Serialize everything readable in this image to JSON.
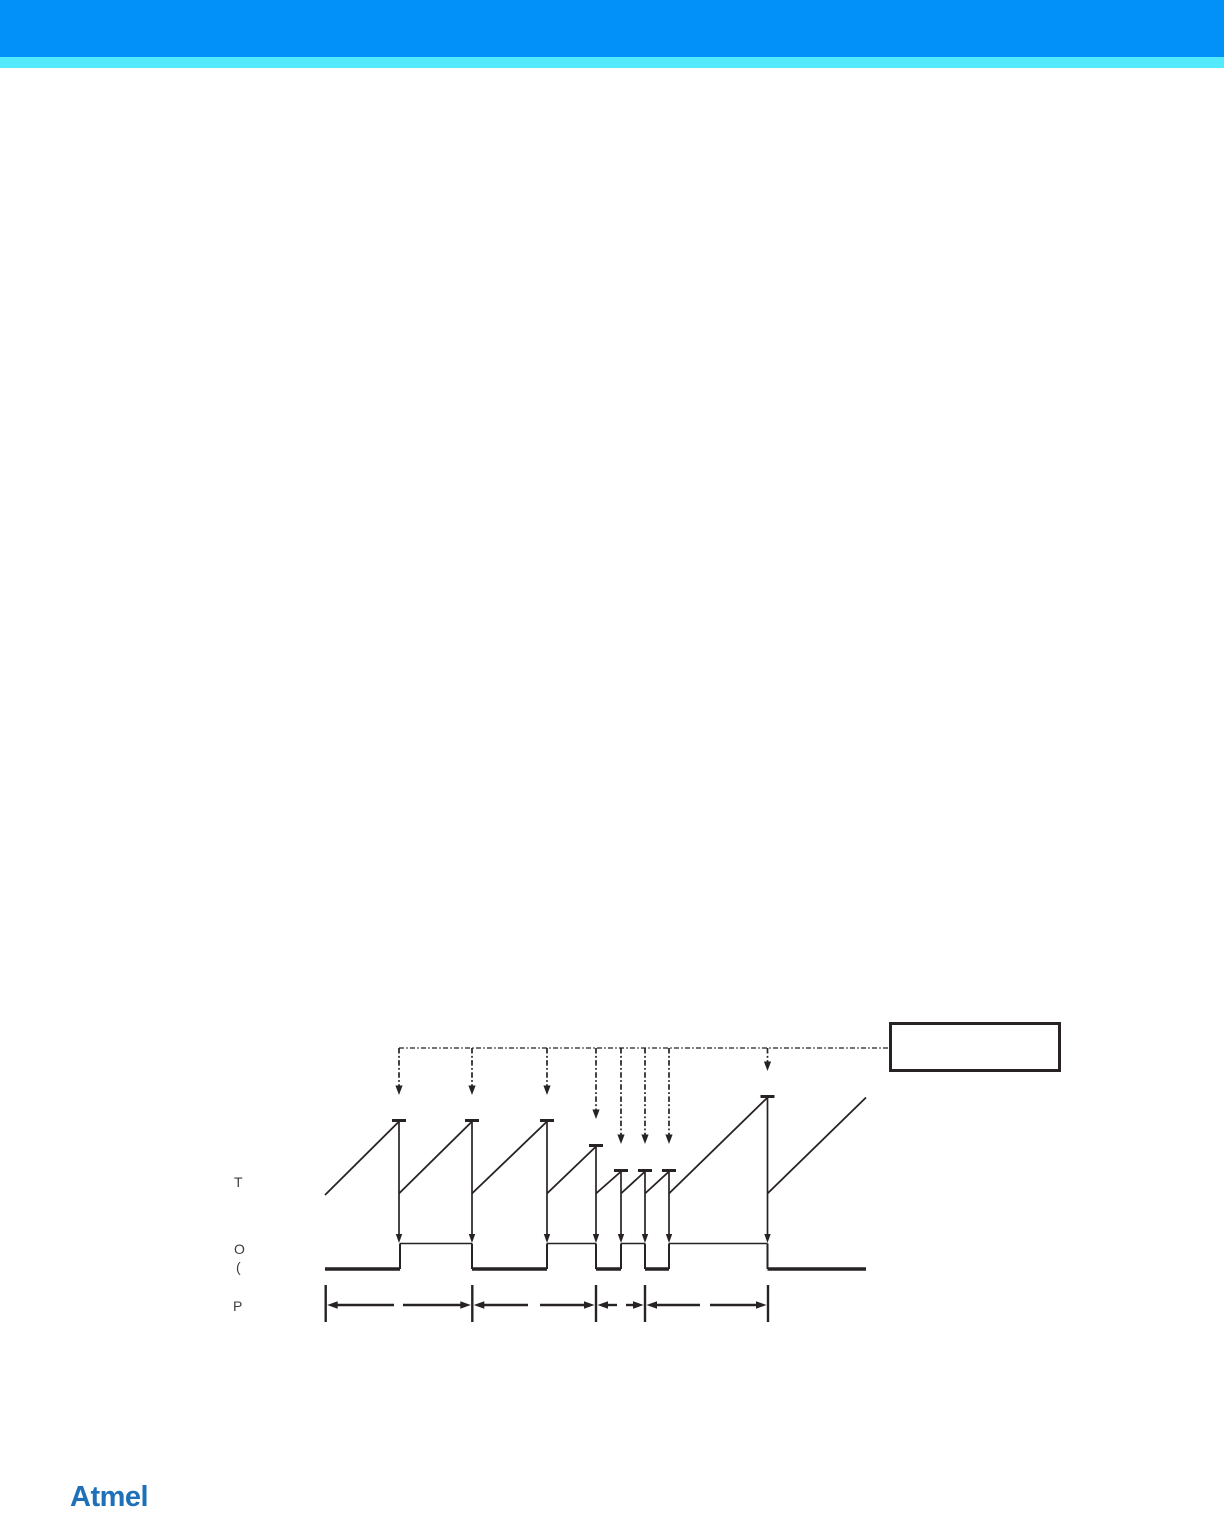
{
  "page": {
    "background": "#ffffff",
    "header": {
      "bar_color": "#0191f8",
      "stripe_color": "#52eafc"
    },
    "footer": {
      "logo_text": "Atmel",
      "logo_color": "#1e70b8"
    }
  },
  "figure": {
    "type": "timing-diagram",
    "ink_color": "#272223",
    "label_color": "#3d3d3d",
    "labels": [
      {
        "id": "counter-label",
        "text": "T"
      },
      {
        "id": "output-label",
        "text": "O"
      },
      {
        "id": "paren-label",
        "text": "("
      },
      {
        "id": "period-label",
        "text": "P"
      }
    ],
    "legend_box": {
      "text": "",
      "x": 889,
      "y": 1022,
      "width": 172,
      "height": 50
    },
    "update_line": {
      "y": 1048,
      "x1": 399,
      "x2": 889
    },
    "update_arrows": [
      {
        "x": 399,
        "tip_y": 1095
      },
      {
        "x": 472,
        "tip_y": 1095
      },
      {
        "x": 547,
        "tip_y": 1095
      },
      {
        "x": 596,
        "tip_y": 1119
      },
      {
        "x": 621,
        "tip_y": 1144
      },
      {
        "x": 645,
        "tip_y": 1144
      },
      {
        "x": 669,
        "tip_y": 1144
      },
      {
        "x": 767.5,
        "tip_y": 1071
      }
    ],
    "sawtooth": {
      "baseline_y": 1193.5,
      "start": {
        "x": 325,
        "y": 1195
      },
      "peaks": [
        {
          "x": 399,
          "top_y": 1120.5
        },
        {
          "x": 472,
          "top_y": 1120.5
        },
        {
          "x": 547,
          "top_y": 1120.5
        },
        {
          "x": 596,
          "top_y": 1145.5
        },
        {
          "x": 621,
          "top_y": 1170.5
        },
        {
          "x": 645,
          "top_y": 1170.5
        },
        {
          "x": 669,
          "top_y": 1170.5
        },
        {
          "x": 767.5,
          "top_y": 1096.5
        }
      ],
      "tail_end": {
        "x": 866,
        "y": 1097.5
      },
      "cap_half_width": 7
    },
    "drop_arrows_tip_y": 1243,
    "output_wave": {
      "high_y": 1243.5,
      "low_y": 1269,
      "start_x": 325,
      "end_x": 866,
      "start_level": "low",
      "transition_xs": [
        400,
        472,
        547,
        596,
        621,
        645,
        669,
        767.5
      ]
    },
    "period": {
      "line_y": 1305,
      "tick_top_y": 1285,
      "tick_bottom_y": 1322,
      "tick_xs": [
        325.7,
        472.3,
        596,
        645,
        768
      ],
      "label_gaps": [
        [
          394,
          403
        ],
        [
          528,
          540
        ],
        [
          617,
          626
        ],
        [
          700,
          710
        ]
      ]
    }
  }
}
